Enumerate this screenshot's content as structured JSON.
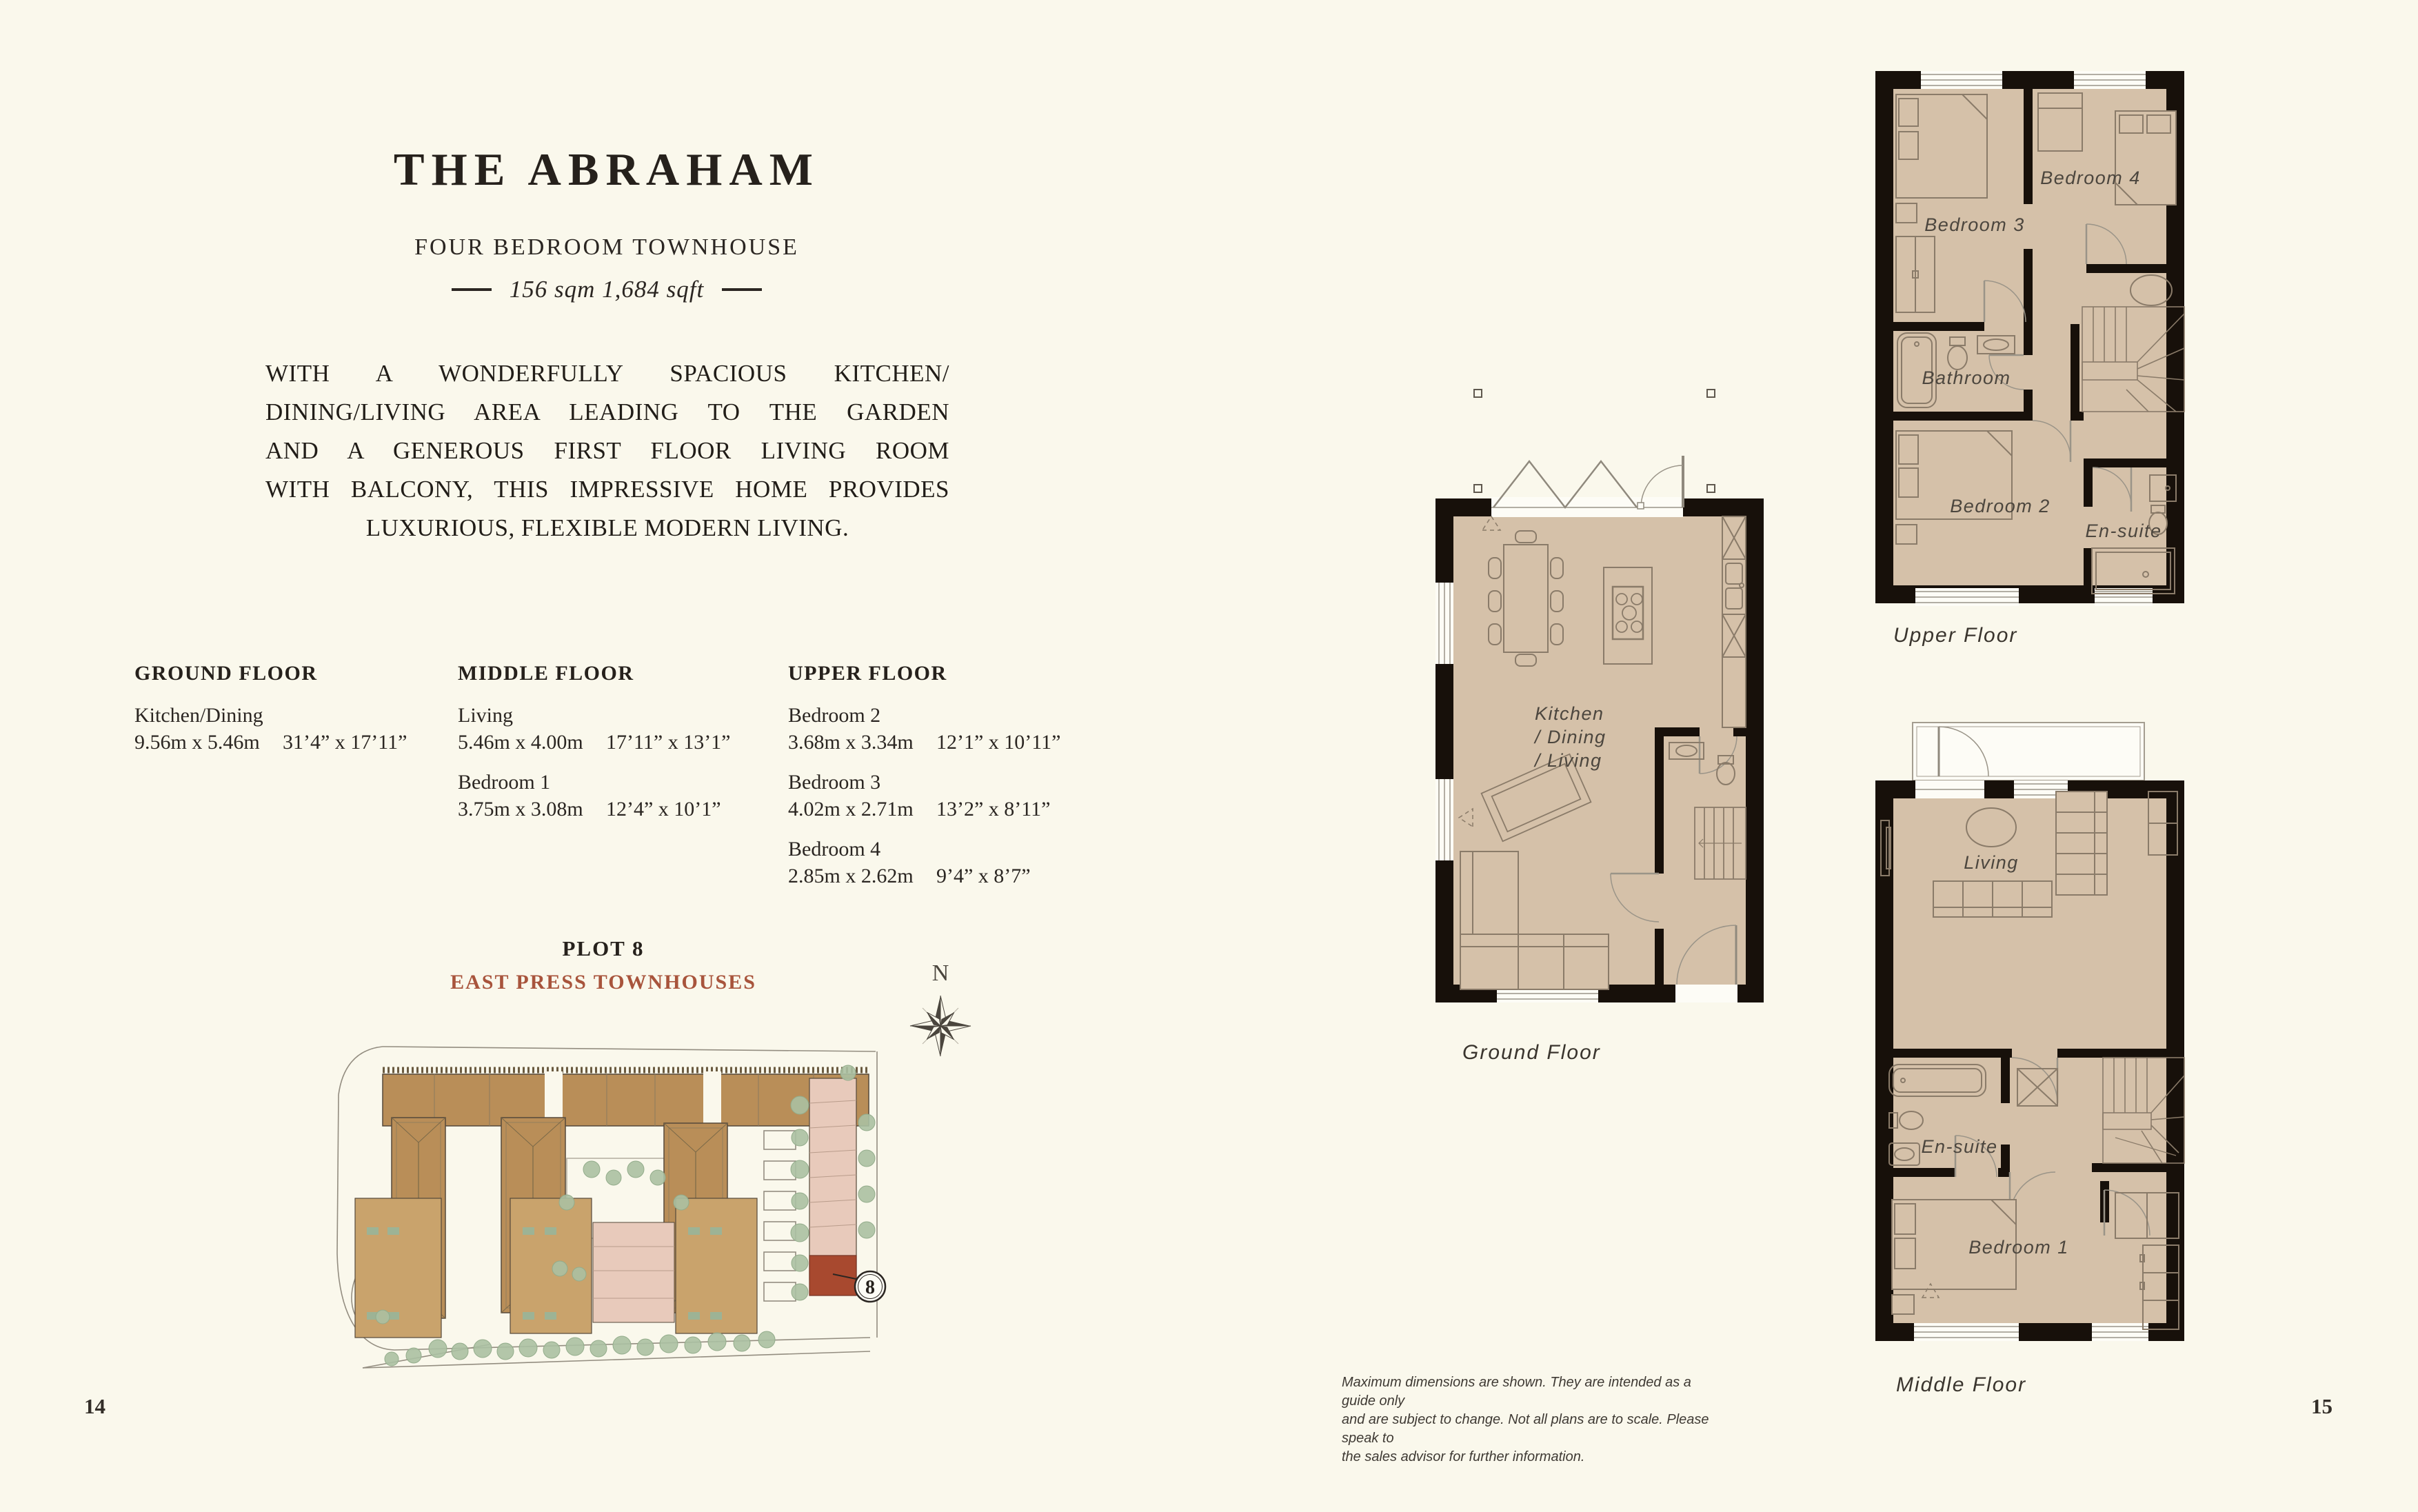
{
  "header": {
    "title": "THE ABRAHAM",
    "subtitle": "FOUR BEDROOM TOWNHOUSE",
    "area": "156 sqm  1,684 sqft"
  },
  "description": {
    "lines": [
      "WITH A WONDERFULLY SPACIOUS KITCHEN/",
      "DINING/LIVING AREA LEADING TO THE GARDEN",
      "AND A GENEROUS FIRST FLOOR LIVING ROOM",
      "WITH BALCONY, THIS IMPRESSIVE HOME PROVIDES",
      "LUXURIOUS, FLEXIBLE MODERN LIVING."
    ]
  },
  "specs": {
    "columns": [
      {
        "heading": "GROUND FLOOR",
        "rooms": [
          {
            "name": "Kitchen/Dining",
            "metric": "9.56m x 5.46m",
            "imperial": "31’4” x 17’11”"
          }
        ]
      },
      {
        "heading": "MIDDLE FLOOR",
        "rooms": [
          {
            "name": "Living",
            "metric": "5.46m x 4.00m",
            "imperial": "17’11” x 13’1”"
          },
          {
            "name": "Bedroom 1",
            "metric": "3.75m x 3.08m",
            "imperial": "12’4” x 10’1”"
          }
        ]
      },
      {
        "heading": "UPPER FLOOR",
        "rooms": [
          {
            "name": "Bedroom 2",
            "metric": "3.68m x 3.34m",
            "imperial": "12’1” x 10’11”"
          },
          {
            "name": "Bedroom 3",
            "metric": "4.02m x 2.71m",
            "imperial": "13’2” x 8’11”"
          },
          {
            "name": "Bedroom 4",
            "metric": "2.85m x 2.62m",
            "imperial": "9’4” x 8’7”"
          }
        ]
      }
    ]
  },
  "site": {
    "plot_label": "PLOT 8",
    "development_name": "EAST PRESS TOWNHOUSES",
    "plot_number": "8",
    "compass_label": "N"
  },
  "plans": {
    "ground": {
      "caption": "Ground Floor",
      "label_lines": [
        "Kitchen",
        "/ Dining",
        "/ Living"
      ]
    },
    "middle": {
      "caption": "Middle Floor",
      "rooms": {
        "living": "Living",
        "ensuite": "En-suite",
        "bedroom1": "Bedroom 1"
      }
    },
    "upper": {
      "caption": "Upper Floor",
      "rooms": {
        "bedroom3": "Bedroom 3",
        "bedroom4": "Bedroom 4",
        "bathroom": "Bathroom",
        "bedroom2": "Bedroom 2",
        "ensuite": "En-suite"
      }
    }
  },
  "footer": {
    "disclaimer_lines": [
      "Maximum dimensions are shown. They are intended as a guide only",
      "and are subject to change. Not all plans are to scale. Please speak to",
      "the sales advisor for further information."
    ],
    "left_page_number": "14",
    "right_page_number": "15"
  },
  "colors": {
    "background": "#faf8ec",
    "ink": "#2b2622",
    "accent_red": "#a8543c",
    "plot_red": "#a8492f",
    "plan_floor_tan": "#d5c1a9",
    "plan_wall_black": "#17100a",
    "site_brown": "#b98e58",
    "site_tan": "#c9a36c",
    "site_pink": "#e8cabb",
    "tree_green": "#abc0a2"
  }
}
